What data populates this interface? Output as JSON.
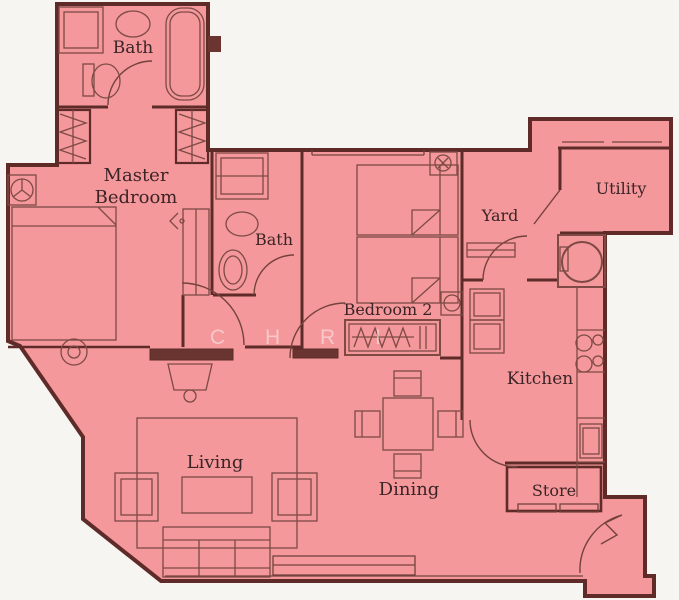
{
  "plan": {
    "kind": "apartment-floor-plan",
    "watermark": {
      "text": "C H R I"
    }
  },
  "colors": {
    "floor": "#F4989B",
    "wall": "#5E2B28",
    "wall_fill": "#6A3431",
    "furniture_line": "#7D4A44",
    "door_line": "#74423C",
    "label_text": "#3B2426",
    "background": "#F6F5F2"
  },
  "rooms": {
    "bath_top": {
      "label": "Bath"
    },
    "master_bedroom": {
      "label_line1": "Master",
      "label_line2": "Bedroom"
    },
    "bath_middle": {
      "label": "Bath"
    },
    "bedroom2": {
      "label": "Bedroom 2"
    },
    "yard": {
      "label": "Yard"
    },
    "utility": {
      "label": "Utility"
    },
    "kitchen": {
      "label": "Kitchen"
    },
    "dining": {
      "label": "Dining"
    },
    "living": {
      "label": "Living"
    },
    "store": {
      "label": "Store"
    }
  },
  "icons": [
    "shower-icon",
    "sink-icon",
    "toilet-icon",
    "bathtub-icon",
    "closet-hanger-icon",
    "ceiling-fan-icon",
    "double-bed-icon",
    "stool-icon",
    "dressing-table-icon",
    "twin-bed-icon",
    "wardrobe-icon",
    "washing-machine-icon",
    "fridge-cabinet-icon",
    "stove-burners-icon",
    "kitchen-sink-icon",
    "counter-icon",
    "dining-table-icon",
    "dining-chair-icon",
    "rug-icon",
    "armchair-icon",
    "coffee-table-icon",
    "sofa-icon",
    "tv-console-icon",
    "window-icon",
    "door-arc-icon"
  ]
}
